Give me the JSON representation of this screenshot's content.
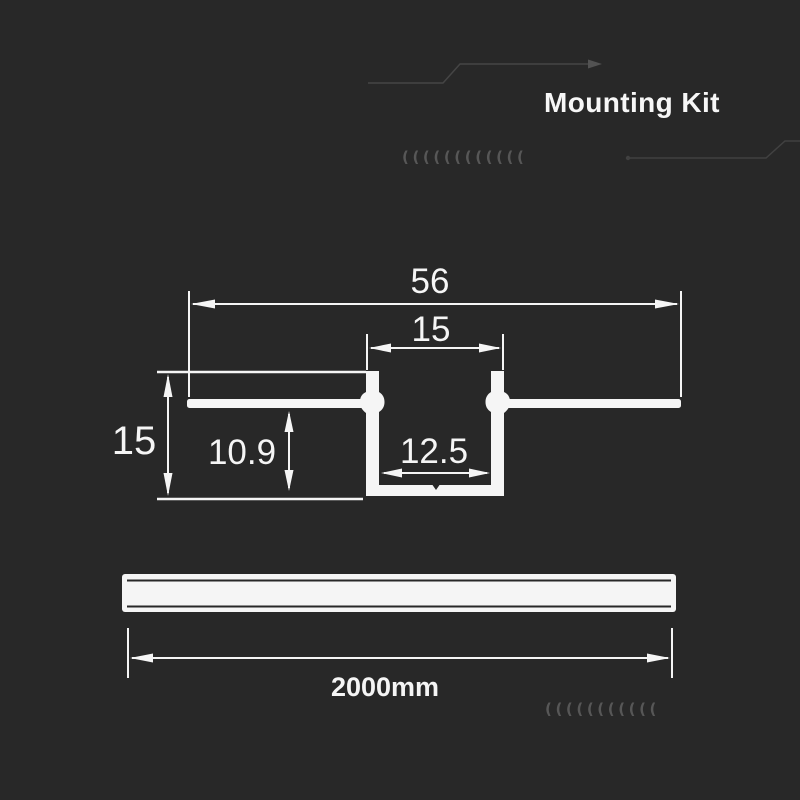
{
  "header": {
    "title": "Mounting Kit"
  },
  "decor": {
    "top_chevrons": "((((((((((((",
    "bottom_chevrons": "((((((((((("
  },
  "diagram": {
    "type": "technical-cross-section",
    "subject": "recessed aluminium profile",
    "dimensions": {
      "overall_width": "56",
      "top_opening_width": "15",
      "overall_height": "15",
      "inner_depth": "10.9",
      "channel_inner_width": "12.5"
    }
  },
  "length_drawing": {
    "length": "2000mm"
  },
  "colors": {
    "background": "#282828",
    "line": "#f5f5f5",
    "trace": "#454545",
    "chevron": "#575757"
  }
}
